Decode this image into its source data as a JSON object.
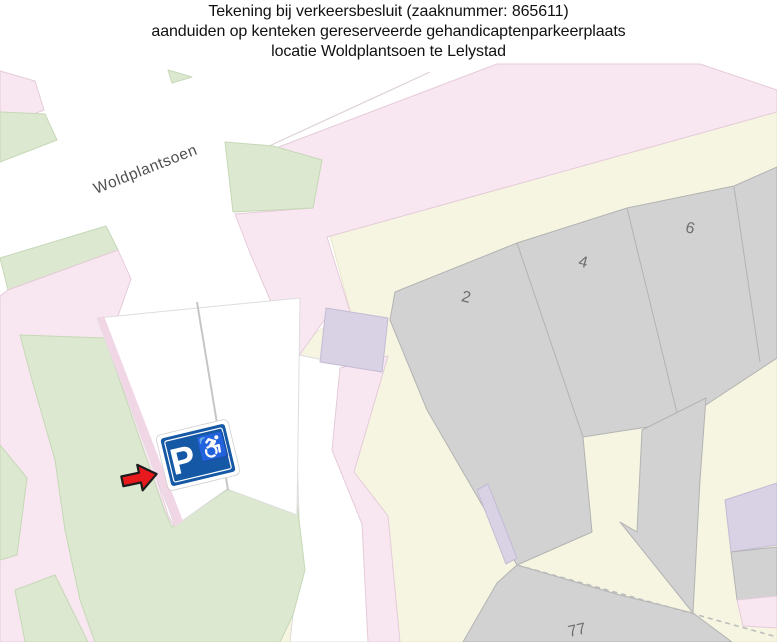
{
  "title": {
    "line1": "Tekening bij verkeersbesluit (zaaknummer: 865611)",
    "line2": "aanduiden op kenteken gereserveerde gehandicaptenparkeerplaats",
    "line3": "locatie Woldplantsoen te Lelystad"
  },
  "map": {
    "street_label": "Woldplantsoen",
    "numbers": [
      {
        "label": "2"
      },
      {
        "label": "4"
      },
      {
        "label": "6"
      },
      {
        "label": "77"
      }
    ],
    "sign": {
      "p_label": "P",
      "wheelchair": "♿"
    },
    "colors": {
      "road_pink": "#f8e7f1",
      "road_pink_stroke": "#e5cbd9",
      "pink_deep": "#f1d7e6",
      "green": "#dce8d0",
      "green_stroke": "#c6d8b6",
      "cream": "#f6f5e1",
      "cream_stroke": "#e8e7cc",
      "building_gray": "#d2d2d2",
      "building_stroke": "#b3b3b3",
      "lavender": "#d9d2e5",
      "lavender_stroke": "#c2bbd4",
      "street_white": "#ffffff",
      "lot_stroke": "#dddddd",
      "divider_gray": "#c6c6c6",
      "dash_gray": "#bdbdbd",
      "curb": "#ddd2da",
      "sign_blue": "#1558a6",
      "sign_white": "#ffffff",
      "sign_edge": "#cfcfcf",
      "arrow_red": "#e8191c",
      "arrow_outline": "#1c1c1c",
      "label_gray": "#4f4f4f",
      "number_gray": "#6f6f6f",
      "title_black": "#111111"
    }
  }
}
